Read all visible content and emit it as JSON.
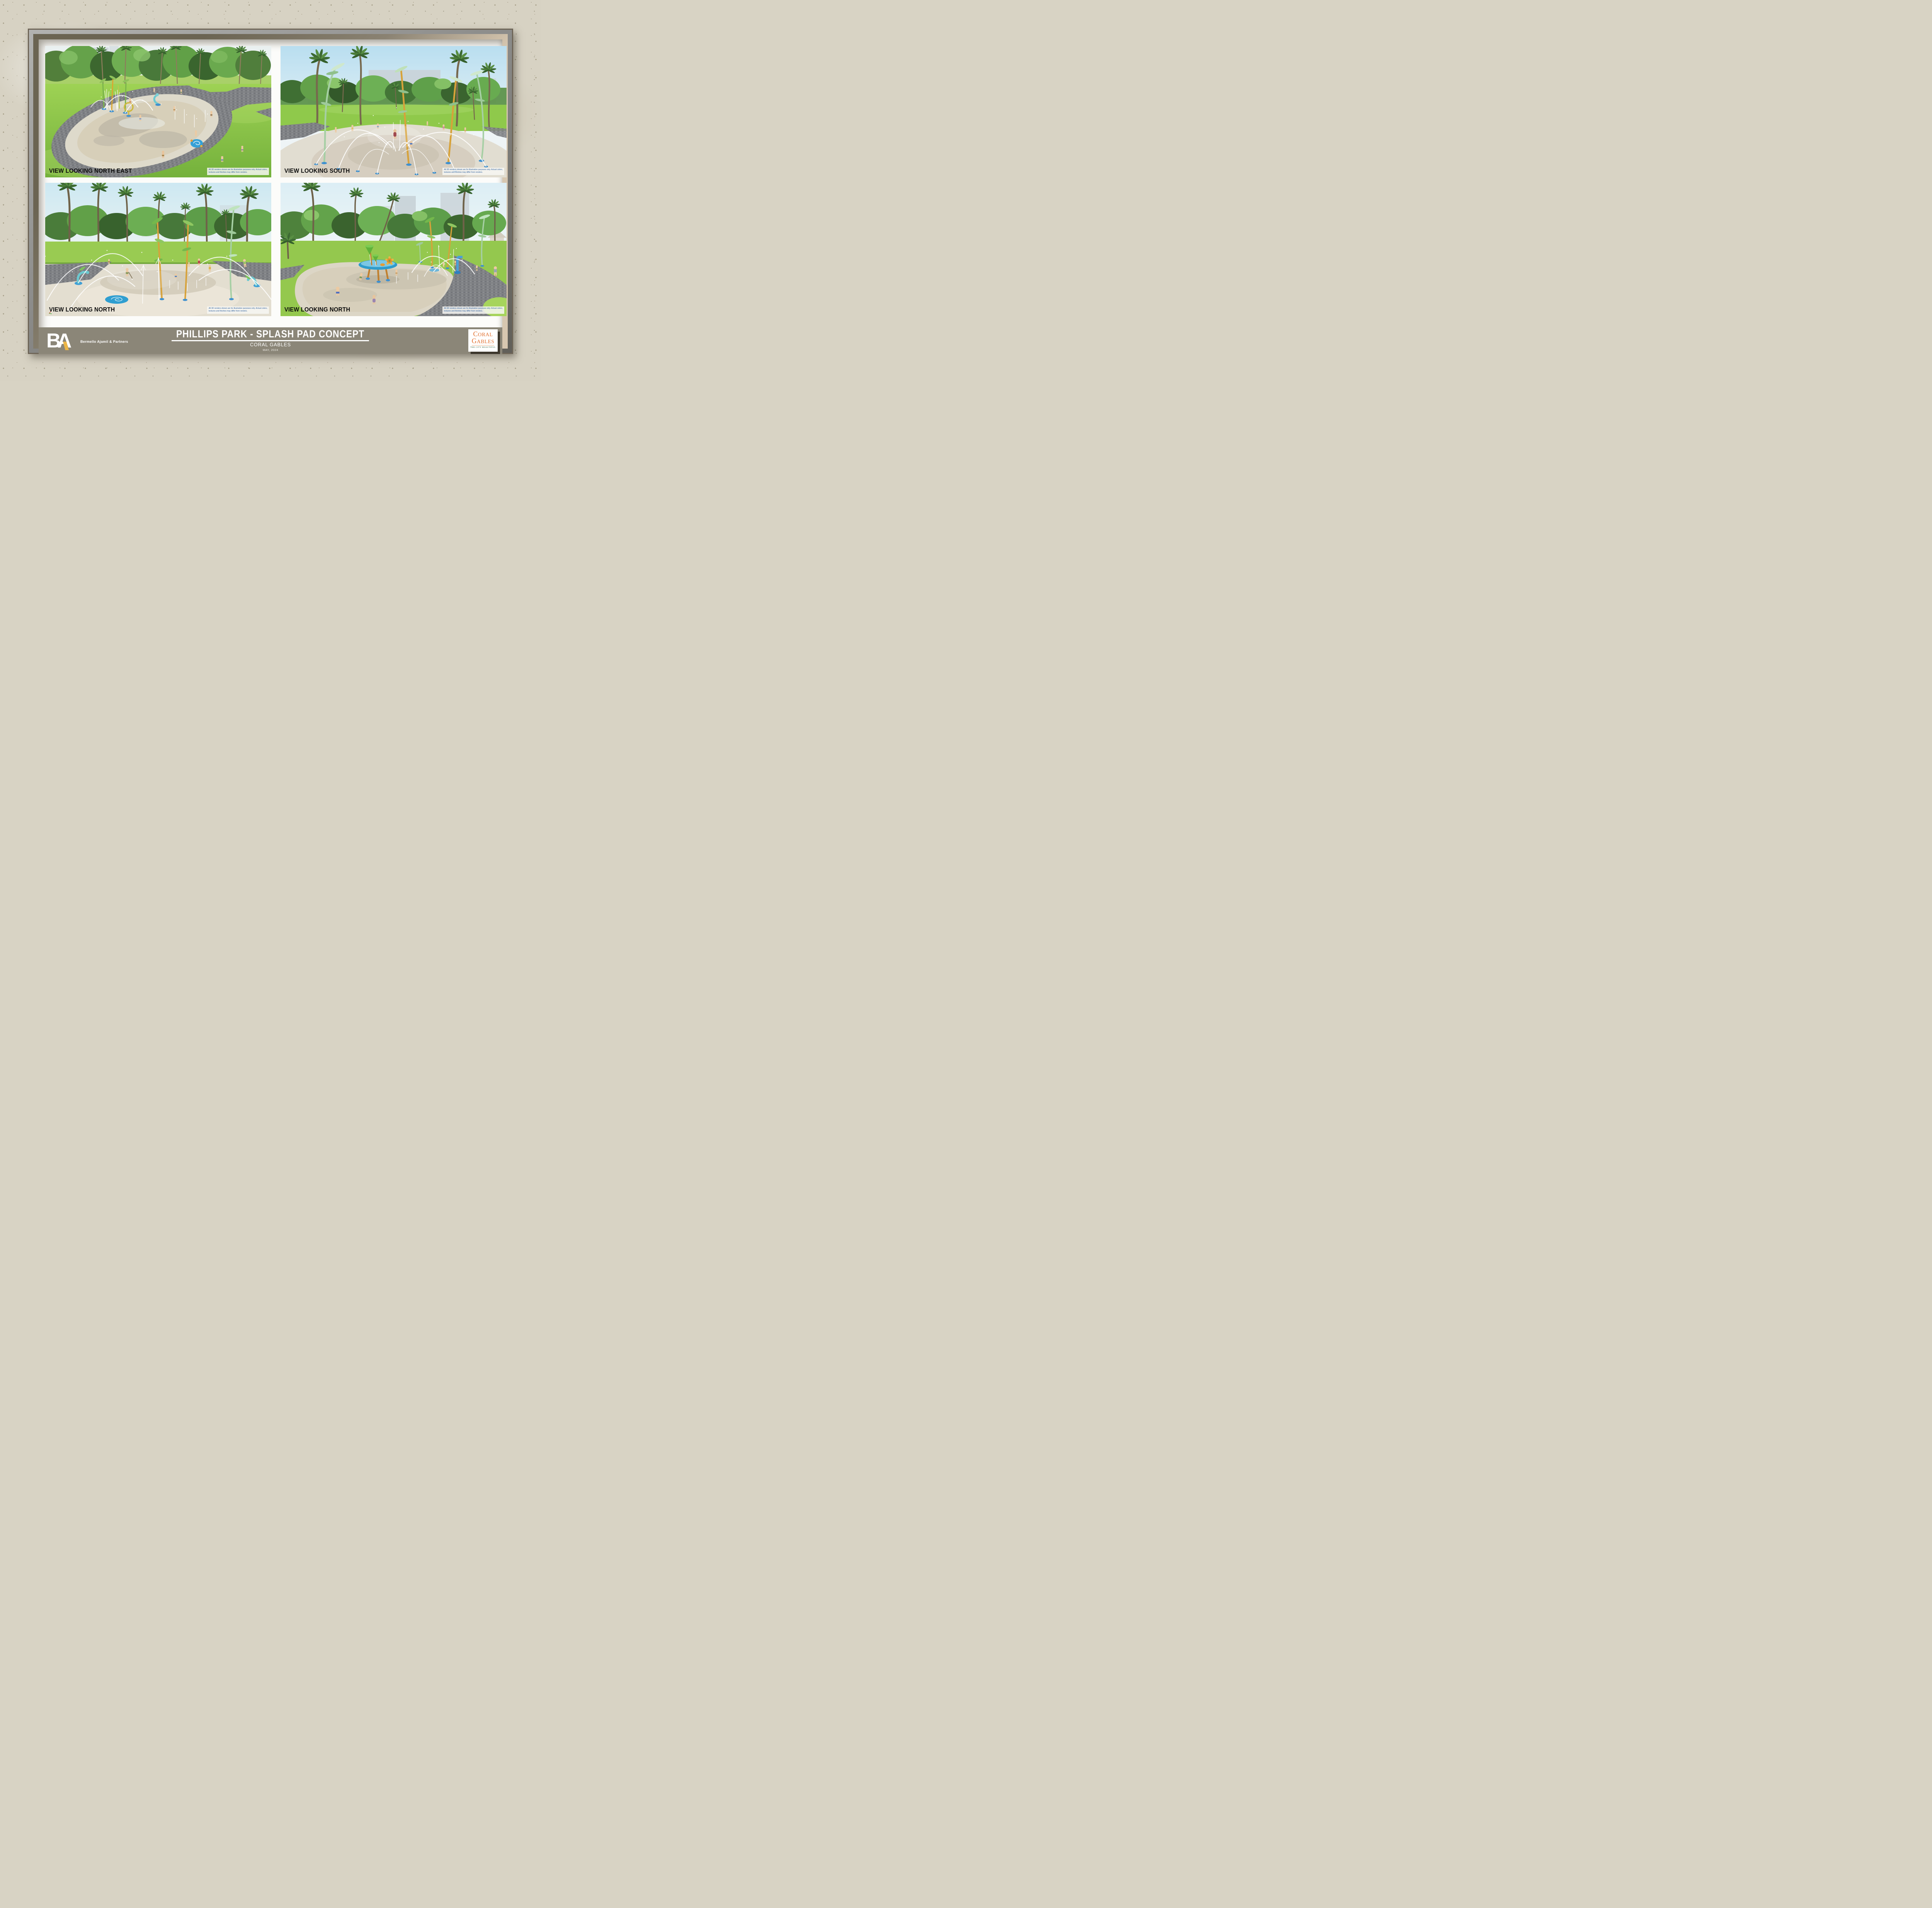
{
  "board": {
    "title": "PHILLIPS PARK - SPLASH PAD CONCEPT",
    "subtitle": "CORAL GABLES",
    "date": "MAY, 2024"
  },
  "branding": {
    "monogram": "BA",
    "firm_name": "Bermello Ajamil & Partners",
    "city_logo": {
      "line1": "CORAL",
      "line2": "GABLES",
      "tagline": "THE CITY BEAUTIFUL"
    }
  },
  "disclaimer": {
    "line1": "All 3D renders shown are for illustration purposes only. Actual colors,",
    "line2": "textures and finishes may differ from renders."
  },
  "panels": [
    {
      "label": "VIEW LOOKING NORTH EAST"
    },
    {
      "label": "VIEW LOOKING SOUTH"
    },
    {
      "label": "VIEW LOOKING NORTH"
    },
    {
      "label": "VIEW LOOKING NORTH"
    }
  ],
  "colors": {
    "title_bar": "#8b8678",
    "frame_tan": "#d7c7b0",
    "mat_white": "#fcfcfa",
    "coral_orange": "#e2702f",
    "city_beautiful_green": "#2e5c34",
    "ba_yellow": "#ecb546",
    "disclaimer_blue": "#2a5d9c",
    "label_black": "#0d0d0d"
  }
}
